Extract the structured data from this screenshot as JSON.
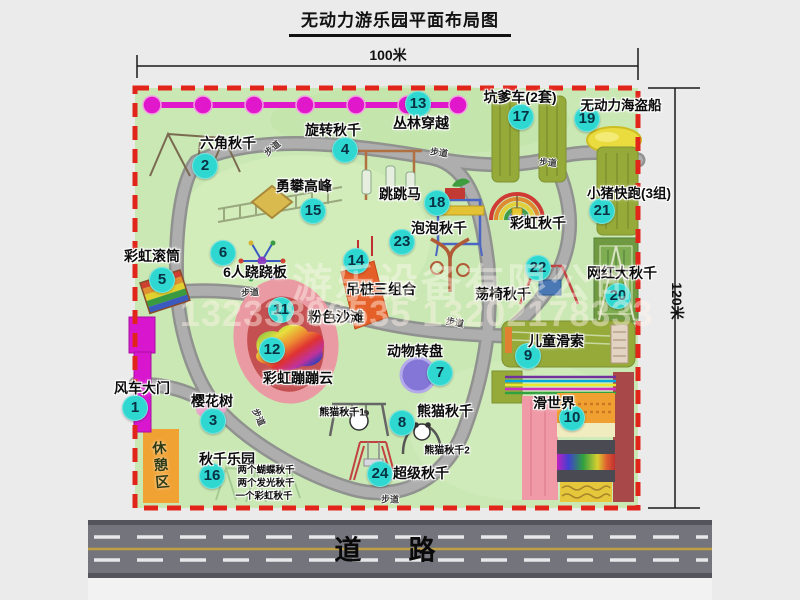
{
  "title": "无动力游乐园平面布局图",
  "dimensions": {
    "width": "100米",
    "height": "120米"
  },
  "road": {
    "label": "道　路"
  },
  "watermark": {
    "company": "游乐设备有限公司",
    "phone": "13233806535 13202178333"
  },
  "rest_area": "休憩区",
  "walkway": "步道",
  "colors": {
    "map_green": "#c9e8b3",
    "border_red": "#e2251b",
    "badge_cyan": "#2ed7d0",
    "zipline_magenta": "#e117cc",
    "olive_green": "#96aa3a",
    "road_gray": "#74747d",
    "rest_orange": "#f0a233",
    "beach_pink": "#ea9aa3",
    "turntable_purple": "#8476d6",
    "pirate_yellow": "#eadb3e"
  },
  "map": {
    "badges": [
      {
        "n": "1",
        "x": 135,
        "y": 408
      },
      {
        "n": "2",
        "x": 205,
        "y": 166
      },
      {
        "n": "3",
        "x": 213,
        "y": 421
      },
      {
        "n": "4",
        "x": 345,
        "y": 150
      },
      {
        "n": "5",
        "x": 162,
        "y": 280
      },
      {
        "n": "6",
        "x": 223,
        "y": 253
      },
      {
        "n": "7",
        "x": 440,
        "y": 373
      },
      {
        "n": "8",
        "x": 402,
        "y": 423
      },
      {
        "n": "9",
        "x": 528,
        "y": 356
      },
      {
        "n": "10",
        "x": 572,
        "y": 418
      },
      {
        "n": "11",
        "x": 281,
        "y": 310
      },
      {
        "n": "12",
        "x": 272,
        "y": 350
      },
      {
        "n": "13",
        "x": 418,
        "y": 104
      },
      {
        "n": "14",
        "x": 356,
        "y": 261
      },
      {
        "n": "15",
        "x": 313,
        "y": 211
      },
      {
        "n": "16",
        "x": 212,
        "y": 476
      },
      {
        "n": "17",
        "x": 521,
        "y": 117
      },
      {
        "n": "18",
        "x": 437,
        "y": 203
      },
      {
        "n": "19",
        "x": 587,
        "y": 119
      },
      {
        "n": "20",
        "x": 618,
        "y": 296
      },
      {
        "n": "21",
        "x": 602,
        "y": 211
      },
      {
        "n": "22",
        "x": 538,
        "y": 268
      },
      {
        "n": "23",
        "x": 402,
        "y": 242
      },
      {
        "n": "24",
        "x": 380,
        "y": 474
      }
    ],
    "labels": [
      {
        "text": "六角秋千",
        "x": 228,
        "y": 143
      },
      {
        "text": "旋转秋千",
        "x": 333,
        "y": 130
      },
      {
        "text": "丛林穿越",
        "x": 421,
        "y": 123
      },
      {
        "text": "坑爹车(2套)",
        "x": 520,
        "y": 97
      },
      {
        "text": "无动力海盗船",
        "x": 621,
        "y": 104,
        "size": 13.5
      },
      {
        "text": "勇攀高峰",
        "x": 304,
        "y": 186
      },
      {
        "text": "跳跳马",
        "x": 400,
        "y": 194
      },
      {
        "text": "小猪快跑(3组)",
        "x": 629,
        "y": 192,
        "size": 13.5
      },
      {
        "text": "彩虹滚筒",
        "x": 152,
        "y": 256
      },
      {
        "text": "6人跷跷板",
        "x": 255,
        "y": 272
      },
      {
        "text": "泡泡秋千",
        "x": 439,
        "y": 228
      },
      {
        "text": "彩虹秋千",
        "x": 538,
        "y": 223
      },
      {
        "text": "网红大秋千",
        "x": 622,
        "y": 273
      },
      {
        "text": "吊桩三组合",
        "x": 381,
        "y": 289
      },
      {
        "text": "荡椅秋千",
        "x": 503,
        "y": 294
      },
      {
        "text": "粉色沙滩",
        "x": 336,
        "y": 317
      },
      {
        "text": "风车大门",
        "x": 142,
        "y": 388
      },
      {
        "text": "彩虹蹦蹦云",
        "x": 298,
        "y": 378
      },
      {
        "text": "动物转盘",
        "x": 415,
        "y": 351
      },
      {
        "text": "儿童滑索",
        "x": 556,
        "y": 341
      },
      {
        "text": "樱花树",
        "x": 212,
        "y": 401
      },
      {
        "text": "熊猫秋千",
        "x": 445,
        "y": 411
      },
      {
        "text": "滑世界",
        "x": 554,
        "y": 403
      },
      {
        "text": "秋千乐园",
        "x": 227,
        "y": 459
      },
      {
        "text": "超级秋千",
        "x": 421,
        "y": 473
      }
    ],
    "small_labels": [
      {
        "text": "熊猫秋千1",
        "x": 342,
        "y": 411,
        "size": 10
      },
      {
        "text": "熊猫秋千2",
        "x": 447,
        "y": 449,
        "size": 10
      },
      {
        "text": "两个蝴蝶秋千",
        "x": 266,
        "y": 469,
        "size": 9.5
      },
      {
        "text": "两个发光秋千",
        "x": 266,
        "y": 482,
        "size": 9.5
      },
      {
        "text": "一个彩虹秋千",
        "x": 264,
        "y": 495,
        "size": 9.5
      }
    ],
    "walkways": [
      {
        "x": 272,
        "y": 148,
        "r": -40
      },
      {
        "x": 439,
        "y": 152,
        "r": 8
      },
      {
        "x": 548,
        "y": 162,
        "r": 5
      },
      {
        "x": 250,
        "y": 292,
        "r": -3
      },
      {
        "x": 455,
        "y": 322,
        "r": 10
      },
      {
        "x": 390,
        "y": 499,
        "r": 0
      },
      {
        "x": 259,
        "y": 417,
        "r": 65
      }
    ]
  }
}
